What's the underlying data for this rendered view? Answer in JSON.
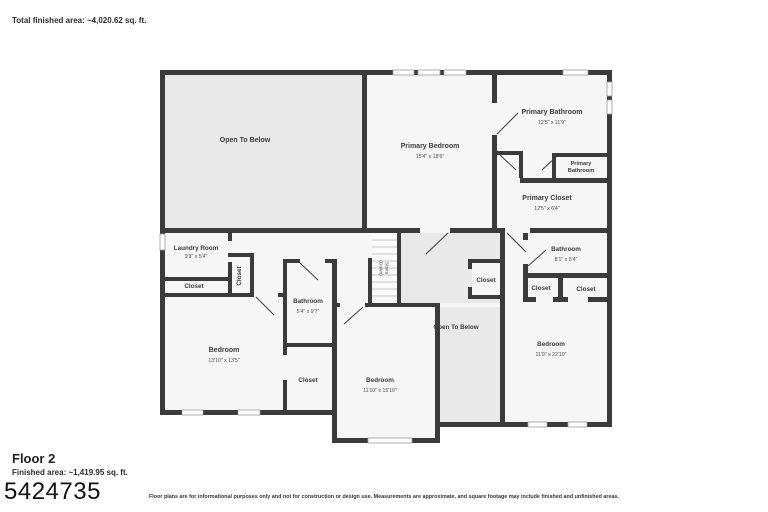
{
  "page": {
    "total_area": "Total finished area: ~4,020.62 sq. ft.",
    "floor_name": "Floor 2",
    "floor_area": "Finished area: ~1,419.95 sq. ft.",
    "watermark": "5424735",
    "disclaimer": "Floor plans are for informational purposes only and not for construction or design use. Measurements are approximate, and square footage may include finished and unfinished areas."
  },
  "rooms": {
    "open_to_below_upper": {
      "label": "Open To Below"
    },
    "primary_bedroom": {
      "label": "Primary Bedroom",
      "dims": "15'4\" x 18'6\""
    },
    "primary_bathroom": {
      "label": "Primary Bathroom",
      "dims": "12'5\" x 11'9\""
    },
    "primary_bathroom_wc": {
      "line1": "Primary",
      "line2": "Bathroom"
    },
    "primary_closet": {
      "label": "Primary Closet",
      "dims": "12'5\" x 6'4\""
    },
    "laundry_room": {
      "label": "Laundry Room",
      "dims": "9'9\" x 5'4\""
    },
    "closet_laundry_side": {
      "label": "Closet"
    },
    "closet_laundry_below": {
      "label": "Closet"
    },
    "bathroom_middle": {
      "label": "Bathroom",
      "dims": "5'4\" x 9'7\""
    },
    "stairs": {
      "line1": "Stairs",
      "line2": "(Down)"
    },
    "closet_middle": {
      "label": "Closet"
    },
    "open_to_below_middle": {
      "label": "Open To Below"
    },
    "bathroom_right": {
      "label": "Bathroom",
      "dims": "8'1\" x 5'4\""
    },
    "closet_right_1": {
      "label": "Closet"
    },
    "closet_right_2": {
      "label": "Closet"
    },
    "bedroom_bottom_left": {
      "label": "Bedroom",
      "dims": "13'10\" x 13'5\""
    },
    "closet_bedroom_left": {
      "label": "Closet"
    },
    "bedroom_bottom_middle": {
      "label": "Bedroom",
      "dims": "11'10\" x 15'10\""
    },
    "bedroom_right": {
      "label": "Bedroom",
      "dims": "11'9\" x 22'10\""
    }
  },
  "colors": {
    "wall": "#3b3b3b",
    "room_fill": "#f6f6f6",
    "open_to_below_fill": "#e9e9e9",
    "window_line": "#9a9a9a",
    "text": "#3c3c3c"
  }
}
